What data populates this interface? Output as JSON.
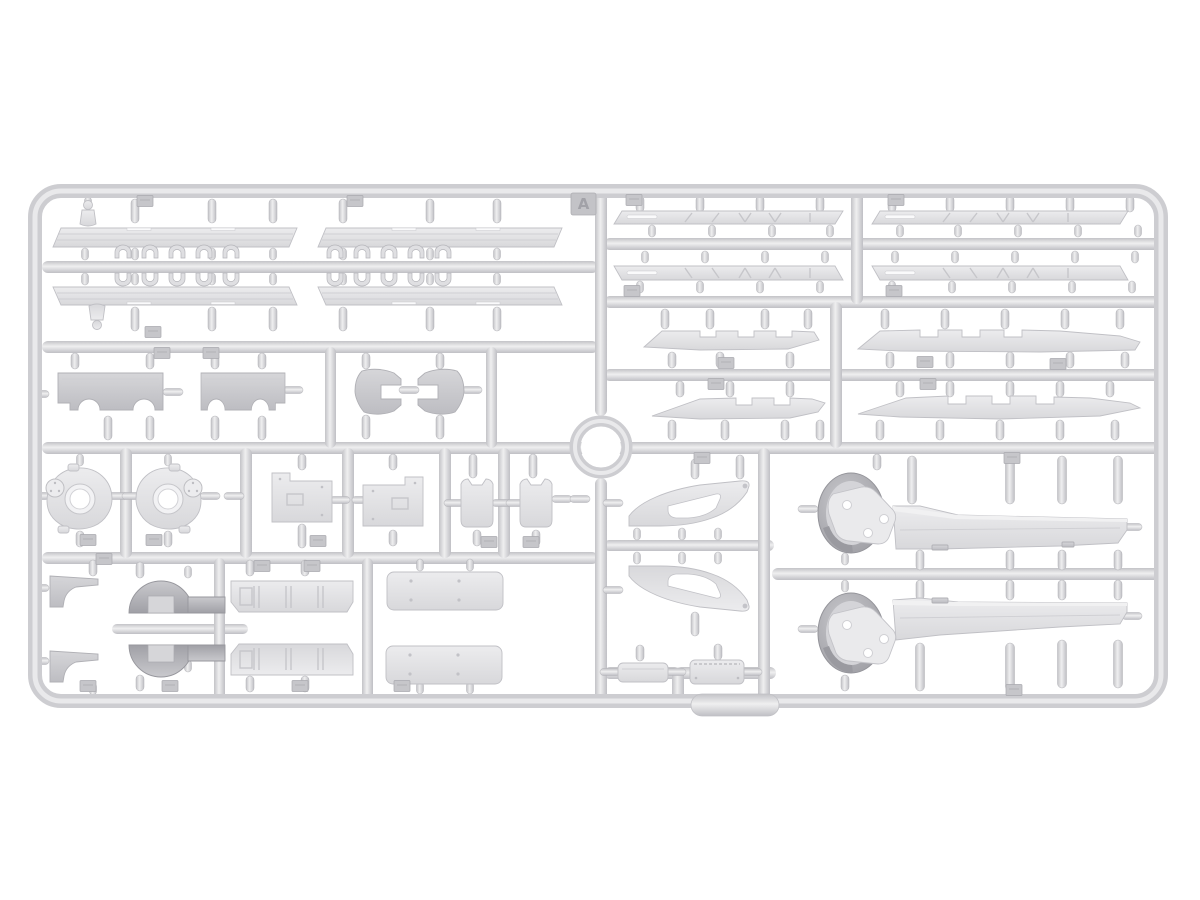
{
  "image": {
    "kind": "product photo",
    "subject": "injection-molded plastic model kit sprue with unassembled parts",
    "background_color": "#ffffff"
  },
  "sprue": {
    "label": "A",
    "plastic": {
      "runner_highlight": "#efeff0",
      "runner_mid": "#c6c6ca",
      "part_light": "#e9e9eb",
      "part_mid": "#d6d6d9",
      "part_shadow": "#a8a8ad"
    },
    "part_groups": [
      {
        "name": "tread-plate-strips",
        "count": 4
      },
      {
        "name": "v-pattern-fender-strips",
        "count": 4
      },
      {
        "name": "notched-skirt-strips",
        "count": 4
      },
      {
        "name": "small-clamp-clips",
        "count": 20
      },
      {
        "name": "lifting-shackles",
        "count": 2
      },
      {
        "name": "arched-engine-panels",
        "count": 2
      },
      {
        "name": "c-shaped-brackets",
        "count": 2
      },
      {
        "name": "final-drive-housings",
        "count": 2
      },
      {
        "name": "stepped-hatch-plates",
        "count": 2
      },
      {
        "name": "two-prong-plates",
        "count": 2
      },
      {
        "name": "flag-step-brackets",
        "count": 2
      },
      {
        "name": "drum-covers-with-wing",
        "count": 2
      },
      {
        "name": "ribbed-floor-strips",
        "count": 2
      },
      {
        "name": "blank-door-panels",
        "count": 2
      },
      {
        "name": "triangular-gusset-brackets",
        "count": 2
      },
      {
        "name": "stowage-boxes",
        "count": 2
      },
      {
        "name": "crane-jib-arms-with-pulley-head",
        "count": 2
      }
    ]
  }
}
